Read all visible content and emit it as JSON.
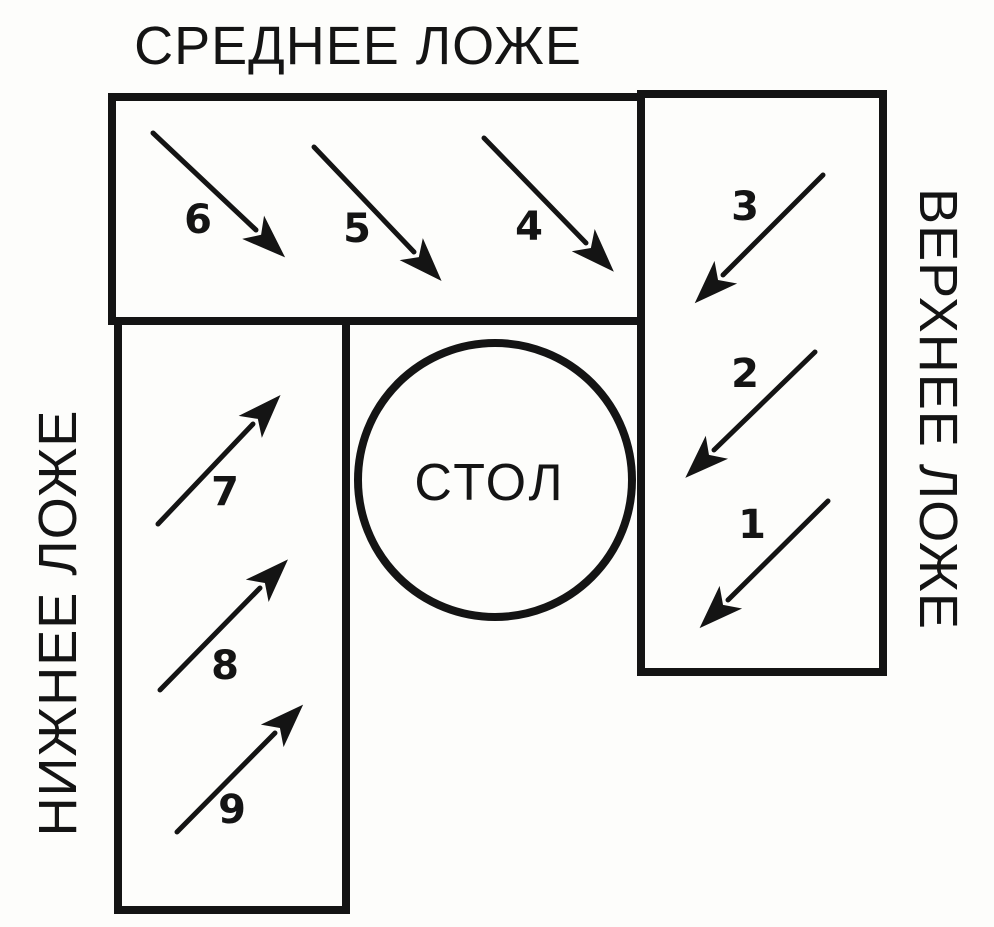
{
  "diagram": {
    "title_top": "СРЕДНЕЕ ЛОЖЕ",
    "label_right": "ВЕРХНЕЕ ЛОЖЕ",
    "label_left": "НИЖНЕЕ ЛОЖЕ",
    "table_label": "СТОЛ"
  },
  "arrows": [
    {
      "label": "1",
      "direction": "down-left",
      "area": "upper-lodge"
    },
    {
      "label": "2",
      "direction": "down-left",
      "area": "upper-lodge"
    },
    {
      "label": "3",
      "direction": "down-left",
      "area": "upper-lodge"
    },
    {
      "label": "4",
      "direction": "down-right",
      "area": "middle-lodge"
    },
    {
      "label": "5",
      "direction": "down-right",
      "area": "middle-lodge"
    },
    {
      "label": "6",
      "direction": "down-right",
      "area": "middle-lodge"
    },
    {
      "label": "7",
      "direction": "up-right",
      "area": "lower-lodge"
    },
    {
      "label": "8",
      "direction": "up-right",
      "area": "lower-lodge"
    },
    {
      "label": "9",
      "direction": "up-right",
      "area": "lower-lodge"
    }
  ],
  "colors": {
    "ink": "#141414",
    "paper": "#fdfdfb"
  }
}
